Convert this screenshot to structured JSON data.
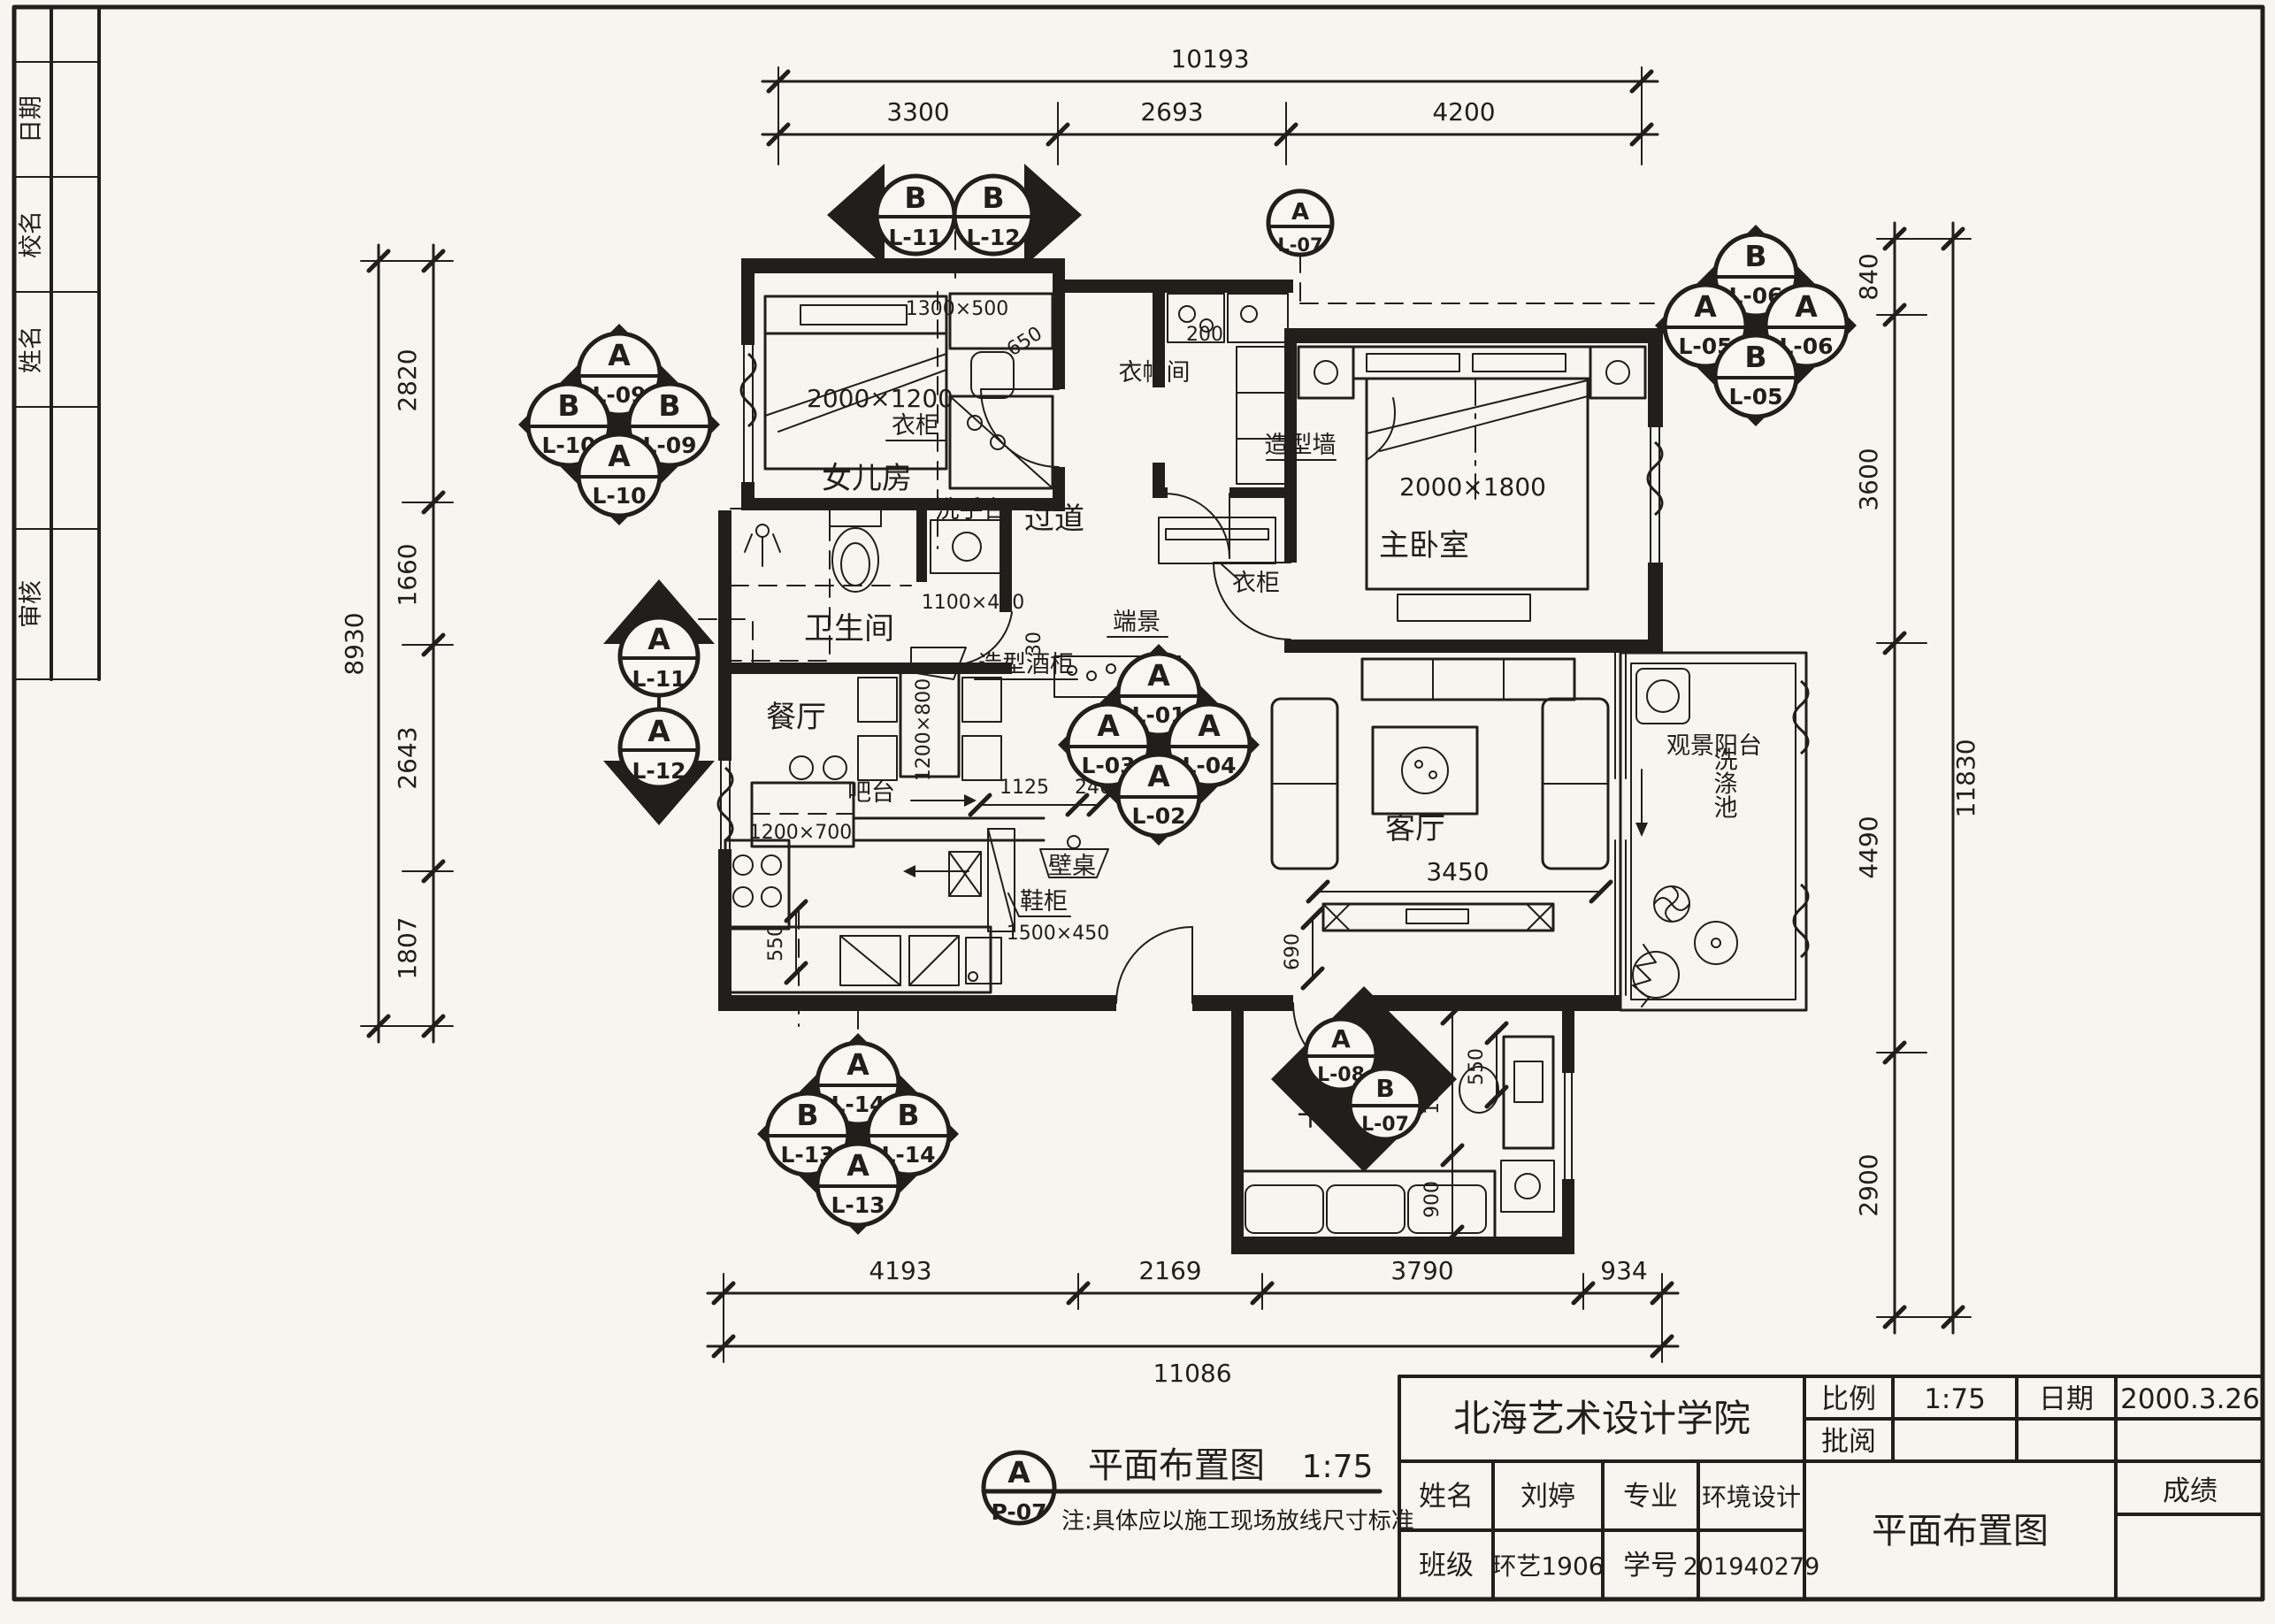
{
  "strip": {
    "c1": "日期",
    "c2": "校名",
    "c3": "姓名",
    "c4": "审核"
  },
  "rooms": {
    "girl": "女儿房",
    "cloak": "衣帽间",
    "master": "主卧室",
    "bath": "卫生间",
    "hall": "过道",
    "dining": "餐厅",
    "living": "客厅",
    "balcony": "观景阳台",
    "study": "书房"
  },
  "labels": {
    "wardrobe_girl": "衣柜",
    "wardrobe_hall": "衣柜",
    "feature_wall": "造型墙",
    "endview": "端景",
    "wine": "造型酒柜",
    "bar": "吧台",
    "walltable": "壁桌",
    "shoecab": "鞋柜",
    "basin": "洗手台",
    "laundry": "洗涤池"
  },
  "sizes": {
    "girl_bed": "2000×1200",
    "girl_cab": "1300×500",
    "d650": "650",
    "d200": "200",
    "d30": "30",
    "basin": "1100×450",
    "master_bed": "2000×1800",
    "table": "1200×800",
    "bar": "1200×700",
    "d1125": "1125",
    "d240": "240",
    "shoe": "1500×450",
    "d550k": "550",
    "tv": "3450",
    "d690": "690",
    "d1880": "1880",
    "d900": "900",
    "d550s": "550"
  },
  "dim_top": {
    "overall": "10193",
    "s1": "3300",
    "s2": "2693",
    "s3": "4200"
  },
  "dim_bottom": {
    "overall": "11086",
    "s1": "4193",
    "s2": "2169",
    "s3": "3790",
    "s4": "934"
  },
  "dim_left": {
    "overall": "8930",
    "s1": "2820",
    "s2": "1660",
    "s3": "2643",
    "s4": "1807"
  },
  "dim_right": {
    "overall": "11830",
    "s1": "840",
    "s2": "3600",
    "s3": "4490",
    "s4": "2900"
  },
  "markers": {
    "tl": {
      "t1": "A",
      "t2": "L-09",
      "l1": "B",
      "l2": "L-10",
      "r1": "B",
      "r2": "L-09",
      "b1": "A",
      "b2": "L-10"
    },
    "tc": {
      "l1": "B",
      "l2": "L-11",
      "r1": "B",
      "r2": "L-12"
    },
    "tr": {
      "t1": "B",
      "t2": "L-06",
      "l1": "A",
      "l2": "L-05",
      "r1": "A",
      "r2": "L-06",
      "b1": "B",
      "b2": "L-05"
    },
    "lm": {
      "u1": "A",
      "u2": "L-11",
      "d1": "A",
      "d2": "L-12"
    },
    "ct": {
      "t1": "A",
      "t2": "L-01",
      "l1": "A",
      "l2": "L-03",
      "r1": "A",
      "r2": "L-04",
      "b1": "A",
      "b2": "L-02"
    },
    "bl": {
      "t1": "A",
      "t2": "L-14",
      "l1": "B",
      "l2": "L-13",
      "r1": "B",
      "r2": "L-14",
      "b1": "A",
      "b2": "L-13"
    },
    "st": {
      "u1": "A",
      "u2": "L-08",
      "r1": "B",
      "r2": "L-07"
    },
    "ev": {
      "t": "A",
      "b": "L-07"
    }
  },
  "caption": {
    "sym_t": "A",
    "sym_b": "P-07",
    "title": "平面布置图",
    "scale": "1:75",
    "note": "注:具体应以施工现场放线尺寸标准"
  },
  "tb": {
    "school": "北海艺术设计学院",
    "scale_l": "比例",
    "scale_v": "1:75",
    "date_l": "日期",
    "date_v": "2000.3.26",
    "review_l": "批阅",
    "name_l": "姓名",
    "name_v": "刘婷",
    "major_l": "专业",
    "major_v": "环境设计",
    "class_l": "班级",
    "class_v": "环艺1906",
    "sid_l": "学号",
    "sid_v": "201940279",
    "drawing": "平面布置图",
    "score_l": "成绩"
  }
}
